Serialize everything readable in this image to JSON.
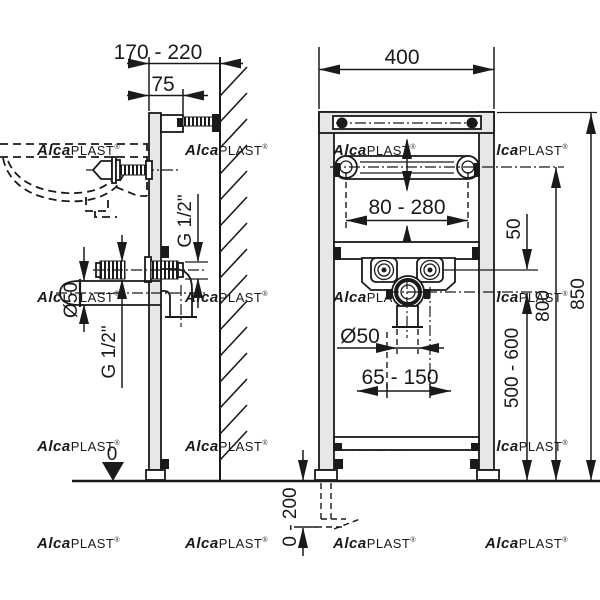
{
  "diagram": {
    "type": "technical-drawing",
    "views": {
      "side": {
        "dims": {
          "depth_range": "170 - 220",
          "wall_offset": "75",
          "supply_thread_upper": "G 1/2\"",
          "supply_thread_lower": "G 1/2\"",
          "drain_diameter": "Ø50",
          "floor_zero": "0"
        }
      },
      "front": {
        "dims": {
          "width": "400",
          "fixing_span": "80 - 280",
          "supply_to_drain_gap": "50",
          "fixing_bar_height": "800",
          "frame_height": "850",
          "drain_height_range": "500 - 600",
          "drain_diameter": "Ø50",
          "drain_offset_range": "65 - 150",
          "leg_adjustment": "0 - 200"
        }
      }
    },
    "watermark": {
      "brand_bold": "Alca",
      "brand_rest": "PLAST",
      "registered": "®",
      "color": "#dcdcdc"
    },
    "colors": {
      "line": "#1a1a1a",
      "frame_fill": "#e7e7e7",
      "background": "#ffffff"
    }
  }
}
